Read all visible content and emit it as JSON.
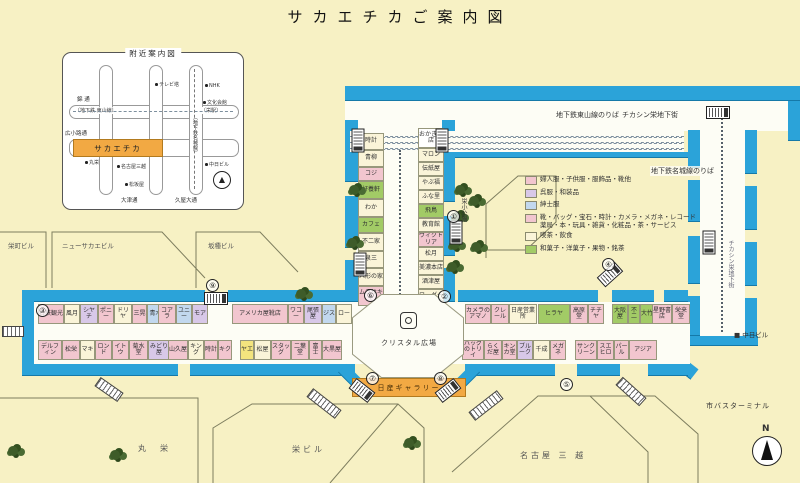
{
  "title": "サカエチカご案内図",
  "inset": {
    "title": "附近案内図",
    "highlight": "サカエチカ",
    "nishiki": "錦 通",
    "hirokoji": "広小路通",
    "otsu": "大津通",
    "hisaya": "久屋大通",
    "higashiyama": "〔地下鉄 東山線〕",
    "sakae_sta": "〔栄駅〕",
    "meijo": "〔地下鉄名城線〕",
    "tv_tower": "テレビ塔",
    "nhk": "NHK",
    "bunka": "文化会館",
    "maruei": "丸栄",
    "mitsukoshi": "名古屋三越",
    "matsuzakaya": "松坂屋",
    "chunichi": "中日ビル"
  },
  "legend": {
    "items": [
      {
        "color": "#F2C6CF",
        "label": "婦人服・子供服・服飾品・靴他"
      },
      {
        "color": "#D8C8E8",
        "label": "呉服・和装品"
      },
      {
        "color": "#C2D8EE",
        "label": "紳士服"
      },
      {
        "color": "#F2C6CF",
        "label": "靴・バッグ・宝石・時計・カメラ・メガネ・レコード 薬局・本・玩具・雑貨・化粧品・茶・サービス"
      },
      {
        "color": "#FAF4D8",
        "label": "喫茶・飲食"
      },
      {
        "color": "#A2CB66",
        "label": "和菓子・洋菓子・果物・銘茶"
      }
    ]
  },
  "labels": {
    "higashiyama_platform": "地下鉄東山線のりば",
    "chikashin": "チカシン栄地下街",
    "meijo_platform": "地下鉄名城線のりば",
    "chikashin_vert": "チカシン栄地下街",
    "sakae_park": "栄小公園",
    "crystal_plaza": "クリスタル広場",
    "nissan_gallery": "日産ギャラリー",
    "bus_terminal": "市バスターミナル",
    "chunichi_bldg": "中日ビル",
    "north": "N"
  },
  "buildings": {
    "maruei": "丸　栄",
    "sakae_bldg": "栄ビル",
    "mitsukoshi": "名古屋 三 越",
    "sakaemachi_bldg": "栄町ビル",
    "new_sakae_bldg": "ニューサカエビル",
    "sakatane_bldg": "坂種ビル"
  },
  "exit_numbers": {
    "n1": "①",
    "n2": "②",
    "n3": "③",
    "n4": "④",
    "n5": "⑤",
    "n6": "⑥",
    "n7": "⑦",
    "n8": "⑧",
    "n9": "⑨"
  },
  "shops": {
    "west_north_1": [
      {
        "label": "名鉄観光",
        "bg": "#F2C6CF",
        "w": 24
      },
      {
        "label": "風月",
        "bg": "#FAF4D8",
        "w": 14
      },
      {
        "label": "シヤチ",
        "bg": "#D8C8E8",
        "w": 16
      },
      {
        "label": "ポニー",
        "bg": "#F2C6CF",
        "w": 14
      },
      {
        "label": "ドリヤ",
        "bg": "#FAF4D8",
        "w": 16
      },
      {
        "label": "三晃",
        "bg": "#F2C6CF",
        "w": 13
      },
      {
        "label": "青木",
        "bg": "#C2D8EE",
        "w": 15
      }
    ],
    "west_north_2": [
      {
        "label": "コアラ",
        "bg": "#F2C6CF",
        "w": 16
      },
      {
        "label": "ユニー",
        "bg": "#C2D8EE",
        "w": 14
      },
      {
        "label": "モア",
        "bg": "#D8C8E8",
        "w": 14
      }
    ],
    "west_north_3": [
      {
        "label": "アメリカ屋靴店",
        "bg": "#F2C6CF",
        "w": 54
      },
      {
        "label": "ワコー",
        "bg": "#F2C6CF",
        "w": 14
      },
      {
        "label": "尾張屋",
        "bg": "#D8C8E8",
        "w": 16
      },
      {
        "label": "ジス",
        "bg": "#C2D8EE",
        "w": 12
      },
      {
        "label": "ロー",
        "bg": "#FAF4D8",
        "w": 14
      }
    ],
    "west_south_1": [
      {
        "label": "デルフィン",
        "bg": "#F2C6CF",
        "w": 22
      },
      {
        "label": "松栄",
        "bg": "#F2C6CF",
        "w": 16
      },
      {
        "label": "マキ",
        "bg": "#FAF4D8",
        "w": 13
      },
      {
        "label": "ロンド",
        "bg": "#F2C6CF",
        "w": 15
      },
      {
        "label": "イトウ",
        "bg": "#F2C6CF",
        "w": 15
      },
      {
        "label": "菊水堂",
        "bg": "#F2C6CF",
        "w": 17
      },
      {
        "label": "みどり屋",
        "bg": "#D8C8E8",
        "w": 20
      }
    ],
    "west_south_2": [
      {
        "label": "山久屋",
        "bg": "#F2C6CF",
        "w": 18
      },
      {
        "label": "キング",
        "bg": "#FAF4D8",
        "w": 14
      },
      {
        "label": "時計",
        "bg": "#F2C6CF",
        "w": 12
      },
      {
        "label": "キク",
        "bg": "#F2C6CF",
        "w": 12
      }
    ],
    "west_south_3": [
      {
        "label": "ヤエ",
        "bg": "#F3E47E",
        "w": 12
      },
      {
        "label": "松屋",
        "bg": "#FAF4D8",
        "w": 15
      },
      {
        "label": "スタッグ",
        "bg": "#F2C6CF",
        "w": 18
      },
      {
        "label": "二葉堂",
        "bg": "#F2C6CF",
        "w": 16
      },
      {
        "label": "富士",
        "bg": "#F2C6CF",
        "w": 11
      },
      {
        "label": "大黒屋",
        "bg": "#F2C6CF",
        "w": 18
      }
    ],
    "center_left": [
      {
        "label": "時計",
        "bg": "#FAF4D8",
        "w": 15
      },
      {
        "label": "青柳",
        "bg": "#FAF4D8",
        "w": 15
      },
      {
        "label": "コジ",
        "bg": "#F2C6CF",
        "w": 12
      },
      {
        "label": "好養軒",
        "bg": "#A2CB66",
        "w": 16
      },
      {
        "label": "わか",
        "bg": "#FAF4D8",
        "w": 16
      },
      {
        "label": "カフェ",
        "bg": "#A2CB66",
        "w": 14
      },
      {
        "label": "不二家",
        "bg": "#FAF4D8",
        "w": 16
      },
      {
        "label": "泉三",
        "bg": "#FAF4D8",
        "w": 15
      },
      {
        "label": "人形の家",
        "bg": "#FAF4D8",
        "w": 16
      },
      {
        "label": "ムラサキヤ",
        "bg": "#F2C6CF",
        "w": 18
      }
    ],
    "center_right": [
      {
        "label": "おかき書店",
        "bg": "#FFFFFF",
        "w": 18
      },
      {
        "label": "マロン",
        "bg": "#FAF4D8",
        "w": 12
      },
      {
        "label": "伝紙屋",
        "bg": "#FAF4D8",
        "w": 12
      },
      {
        "label": "やぶ福",
        "bg": "#FAF4D8",
        "w": 12
      },
      {
        "label": "ふな里",
        "bg": "#FAF4D8",
        "w": 12
      },
      {
        "label": "飛鳥",
        "bg": "#A2CB66",
        "w": 12
      },
      {
        "label": "教育館",
        "bg": "#FAF4D8",
        "w": 12
      },
      {
        "label": "ヴィクトリア",
        "bg": "#F2C6CF",
        "w": 13
      },
      {
        "label": "松月",
        "bg": "#FAF4D8",
        "w": 12
      },
      {
        "label": "美濃本店",
        "bg": "#FAF4D8",
        "w": 12
      },
      {
        "label": "酒津屋",
        "bg": "#FAF4D8",
        "w": 12
      },
      {
        "label": "ワーグー",
        "bg": "#FAF4D8",
        "w": 12
      },
      {
        "label": "案内所",
        "bg": "#F2C6CF",
        "w": 14
      }
    ],
    "east_north_1": [
      {
        "label": "カメラのアマノ",
        "bg": "#F2C6CF",
        "w": 24
      },
      {
        "label": "クレール",
        "bg": "#F2C6CF",
        "w": 16
      },
      {
        "label": "日産営業所",
        "bg": "#FAF4D8",
        "w": 26
      }
    ],
    "east_north_2": [
      {
        "label": "ヒラヤ",
        "bg": "#A2CB66",
        "w": 30
      },
      {
        "label": "高原堂",
        "bg": "#F2C6CF",
        "w": 16
      },
      {
        "label": "チチヤ",
        "bg": "#F2C6CF",
        "w": 14
      }
    ],
    "east_north_3": [
      {
        "label": "大阪屋",
        "bg": "#A2CB66",
        "w": 14
      },
      {
        "label": "不二",
        "bg": "#A2CB66",
        "w": 10
      },
      {
        "label": "大竹",
        "bg": "#A2CB66",
        "w": 12
      }
    ],
    "east_north_4": [
      {
        "label": "星野書店",
        "bg": "#F2C6CF",
        "w": 18
      },
      {
        "label": "栄来堂",
        "bg": "#F2C6CF",
        "w": 16
      }
    ],
    "east_south_1": [
      {
        "label": "バッグのトリイ",
        "bg": "#F2C6CF",
        "w": 20
      },
      {
        "label": "らくだ屋",
        "bg": "#F2C6CF",
        "w": 16
      },
      {
        "label": "キンカ堂",
        "bg": "#F2C6CF",
        "w": 13
      },
      {
        "label": "ブルーク",
        "bg": "#D8C8E8",
        "w": 14
      },
      {
        "label": "千成",
        "bg": "#FAF4D8",
        "w": 15
      },
      {
        "label": "メガネ",
        "bg": "#F2C6CF",
        "w": 14
      }
    ],
    "east_south_2": [
      {
        "label": "サンクリーン",
        "bg": "#F2C6CF",
        "w": 20
      },
      {
        "label": "スエヒロ",
        "bg": "#F2C6CF",
        "w": 15
      },
      {
        "label": "パール",
        "bg": "#F2C6CF",
        "w": 13
      },
      {
        "label": "アジア",
        "bg": "#F2C6CF",
        "w": 26
      }
    ]
  }
}
